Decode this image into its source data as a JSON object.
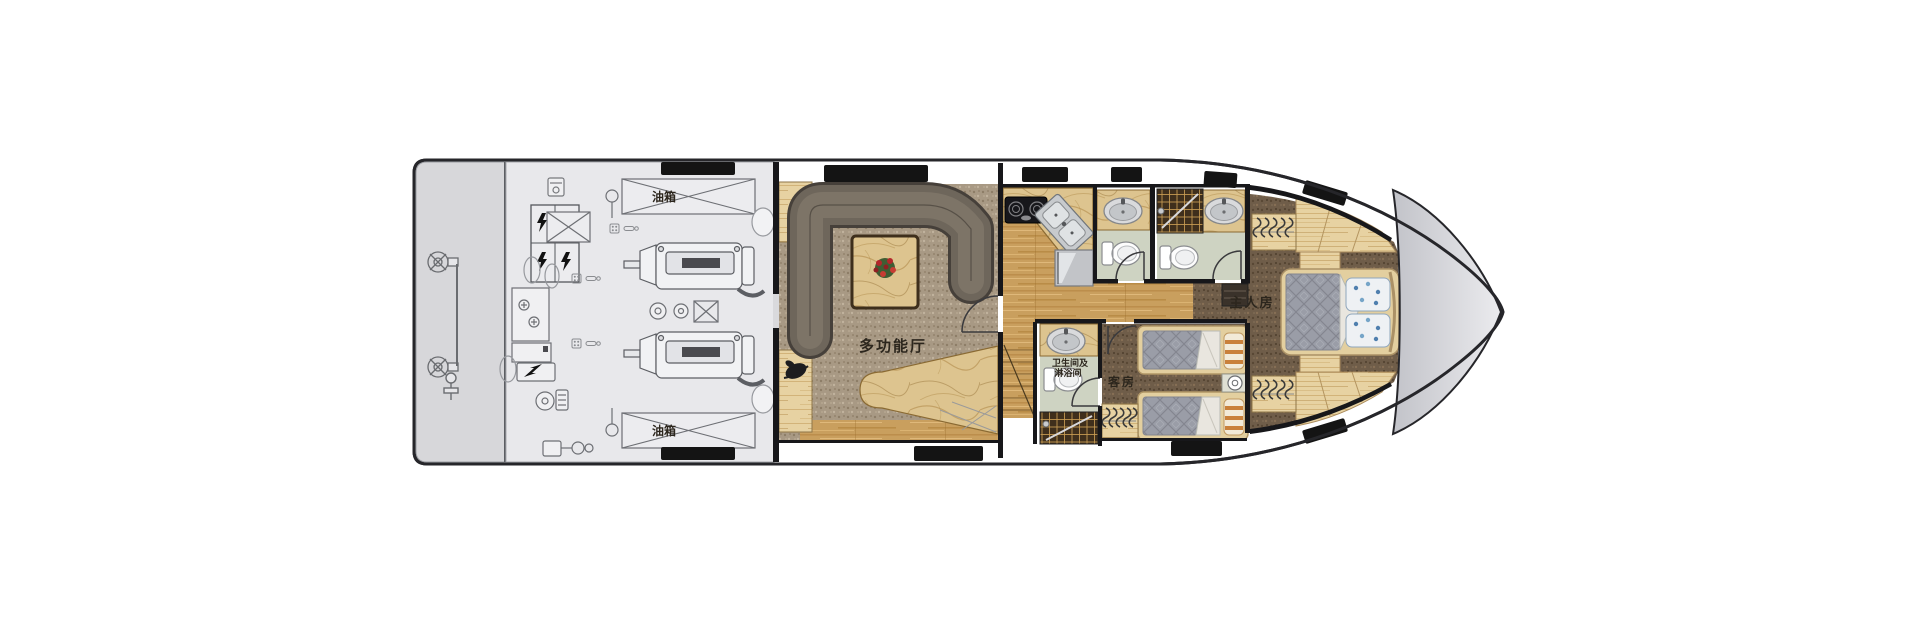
{
  "rooms": {
    "engine_room": {
      "fuel_tank_label": "油箱"
    },
    "lounge": {
      "label": "多功能厅"
    },
    "guest_bathroom": {
      "label_line_1": "卫生间及",
      "label_line_2": "淋浴间"
    },
    "guest_cabin": {
      "label": "客房"
    },
    "master_cabin": {
      "label": "主人房"
    }
  },
  "colors": {
    "hull_outline": "#26262a",
    "deck": "#ffffff",
    "swim_platform": "#d7d7da",
    "engine_room_floor": "#e8e8eb",
    "wood_floor": "#c99f5e",
    "light_wood": "#e7d2a2",
    "lounge_carpet": "#a89984",
    "cabin_carpet": "#6f5d49",
    "sofa": "#6e665b",
    "marble": "#ddc48f",
    "bathroom_floor": "#ced3c2",
    "shower_mosaic": "#3f2f1c",
    "mattress": "#9a9da7",
    "bed_frame": "#e3cf9f",
    "window": "#141414",
    "bow_deck": "#c9cacf",
    "label_text": "#2c261d"
  }
}
